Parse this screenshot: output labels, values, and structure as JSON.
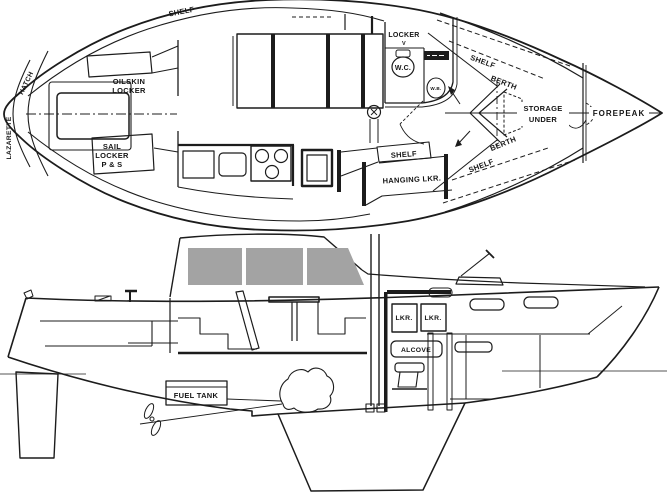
{
  "drawing": {
    "type": "sailboat-interior-arrangement-drawing",
    "views": [
      "plan (overhead)",
      "profile (side)"
    ]
  },
  "colors": {
    "line": "#1c1c1c",
    "window_gray": "#a3a3a3",
    "paper": "#ffffff"
  },
  "plan": {
    "lazarette": "LAZARETTE",
    "hatch": "HATCH",
    "shelf_port_aft": "SHELF",
    "oilskin_1": "OILSKIN",
    "oilskin_2": "LOCKER",
    "sail_1": "SAIL",
    "sail_2": "LOCKER",
    "sail_3": "P & S",
    "locker": "LOCKER",
    "locker_v": "V",
    "wc": "W.C.",
    "basin": "W.B.",
    "shelf_aft": "SHELF",
    "hanging_locker": "HANGING LKR.",
    "shelf_fwd_upper": "SHELF",
    "berth_fwd_upper": "BERTH",
    "berth_fwd_lower": "BERTH",
    "shelf_fwd_lower": "SHELF",
    "storage_1": "STORAGE",
    "storage_2": "UNDER",
    "forepeak": "FOREPEAK"
  },
  "profile": {
    "lkr_a": "LKR.",
    "lkr_b": "LKR.",
    "alcove": "ALCOVE",
    "fuel_tank": "FUEL TANK"
  }
}
